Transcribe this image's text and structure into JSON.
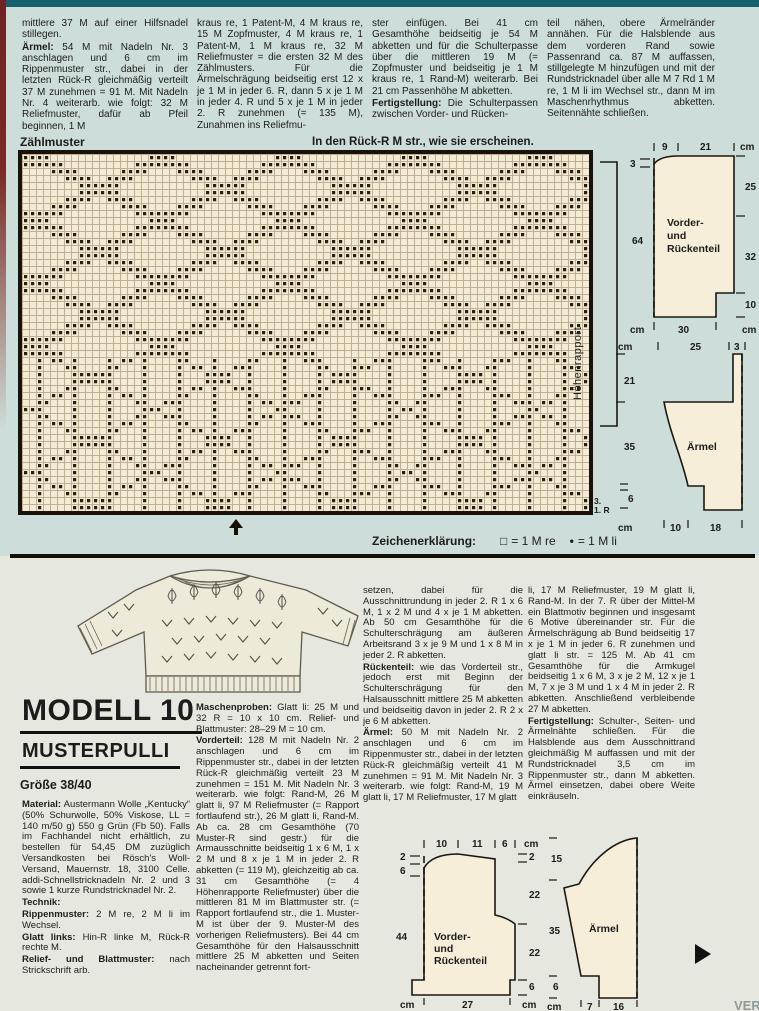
{
  "page": {
    "bg_top": "#cdddd9",
    "bg_bottom": "#e6e8e0",
    "teal_bar": "#155f6e",
    "spine": "#7b2a26",
    "divider": "#141008"
  },
  "top_article": {
    "col1": [
      [
        {
          "t": "mittlere 37 M auf einer Hilfsnadel stillegen."
        }
      ],
      [
        {
          "b": "Ärmel:"
        },
        {
          "t": " 54 M mit Nadeln Nr. 3 anschlagen und 6 cm im Rippenmuster str., dabei in der letzten Rück-R gleichmäßig verteilt 37 M zunehmen = 91 M. Mit Nadeln Nr. 4 weiterarb. wie folgt: 32 M Reliefmuster, dafür ab Pfeil beginnen, 1 M"
        }
      ]
    ],
    "col2": [
      [
        {
          "t": "kraus re, 1 Patent-M, 4 M kraus re, 15 M Zopfmuster, 4 M kraus re, 1 Patent-M, 1 M kraus re, 32 M Reliefmuster = die ersten 32 M des Zählmusters. Für die Ärmelschrägung beidseitig erst 12 x je 1 M in jeder 6. R, dann 5 x je 1 M in jeder 4. R und 5 x je 1 M in jeder 2. R zunehmen (= 135 M), Zunahmen ins Reliefmu-"
        }
      ]
    ],
    "col3": [
      [
        {
          "t": "ster einfügen. Bei 41 cm Gesamthöhe beidseitig je 54 M abketten und für die Schulterpasse über die mittleren 19 M (= Zopfmuster und beidseitig je 1 M kraus re, 1 Rand-M) weiterarb. Bei 21 cm Passenhöhe M abketten."
        }
      ],
      [
        {
          "b": "Fertigstellung:"
        },
        {
          "t": " Die Schulterpassen zwischen Vorder- und Rücken-"
        }
      ]
    ],
    "col4": [
      [
        {
          "t": "teil nähen, obere Ärmelränder annähen. Für die Halsblende aus dem vorderen Rand sowie Passenrand ca. 87 M auffassen, stillgelegte M hinzufügen und mit der Rundstricknadel über alle M 7 Rd 1 M re, 1 M li im Wechsel str., dann M im Maschenrhythmus abketten. Seitennähte schließen."
        }
      ]
    ]
  },
  "chart": {
    "title": "Zählmuster",
    "note": "In den Rück-R M str., wie sie erscheinen.",
    "side_label": "Höhenrapport",
    "mark_top": "3.",
    "mark_bottom": "1. R",
    "cols": 81,
    "rows": 51,
    "colors": {
      "bg": "#f3ebd6",
      "grid": "#bfb190",
      "dot": "#281e12"
    },
    "pattern": {
      "period": 18,
      "run": 4,
      "lower_start": 29,
      "stem_every": 5
    },
    "legend": {
      "title": "Zeichenerklärung:",
      "sq_symbol": "□",
      "sq_text": "= 1 M re",
      "dot_symbol": "•",
      "dot_text": "= 1 M li"
    }
  },
  "model": {
    "title": "MODELL 10",
    "subtitle": "MUSTERPULLI",
    "size": "Größe 38/40"
  },
  "bottom_article": {
    "col1": [
      [
        {
          "b": "Material:"
        },
        {
          "t": " Austermann Wolle „Kentucky“ (50% Schurwolle, 50% Viskose, LL = 140 m/50 g) 550 g Grün (Fb 50). Falls im Fachhandel nicht erhältlich, zu bestellen für 54,45 DM zuzüglich Versandkosten bei Rösch's Woll-Versand, Mauernstr. 18, 3100 Celle. addi-Schnellstricknadeln Nr. 2 und 3 sowie 1 kurze Rundstricknadel Nr. 2."
        }
      ],
      [
        {
          "b": "Technik:"
        }
      ],
      [
        {
          "b": "Rippenmuster:"
        },
        {
          "t": " 2 M re, 2 M li im Wechsel."
        }
      ],
      [
        {
          "b": "Glatt links:"
        },
        {
          "t": " Hin-R linke M, Rück-R rechte M."
        }
      ],
      [
        {
          "b": "Relief- und Blattmuster:"
        },
        {
          "t": " nach Strickschrift arb."
        }
      ]
    ],
    "col2": [
      [
        {
          "b": "Maschenproben:"
        },
        {
          "t": " Glatt li: 25 M und 32 R = 10 x 10 cm. Relief- und Blattmuster: 28–29 M = 10 cm."
        }
      ],
      [
        {
          "b": "Vorderteil:"
        },
        {
          "t": " 128 M mit Nadeln Nr. 2 anschlagen und 6 cm im Rippenmuster str., dabei in der letzten Rück-R gleichmäßig verteilt 23 M zunehmen = 151 M. Mit Nadeln Nr. 3 weiterarb. wie folgt: Rand-M, 26 M glatt li, 97 M Reliefmuster (= Rapport fortlaufend str.), 26 M glatt li, Rand-M. Ab ca. 28 cm Gesamthöhe (70 Muster-R sind gestr.) für die Armausschnitte beidseitig 1 x 6 M, 1 x 2 M und 8 x je 1 M in jeder 2. R abketten (= 119 M), gleichzeitig ab ca. 31 cm Gesamthöhe (= 4 Höhenrapporte Reliefmuster) über die mittleren 81 M im Blattmuster str. (= Rapport fortlaufend str., die 1. Muster-M ist über der 9. Muster-M des vorherigen Reliefmusters). Bei 44 cm Gesamthöhe für den Halsausschnitt mittlere 25 M abketten und Seiten nacheinander getrennt fort-"
        }
      ]
    ],
    "col3": [
      [
        {
          "t": "setzen, dabei für die Ausschnittrundung in jeder 2. R 1 x 6 M, 1 x 2 M und 4 x je 1 M abketten. Ab 50 cm Gesamthöhe für die Schulterschrägung am äußeren Arbeitsrand 3 x je 9 M und 1 x 8 M in jeder 2. R abketten."
        }
      ],
      [
        {
          "b": "Rückenteil:"
        },
        {
          "t": " wie das Vorderteil str., jedoch erst mit Beginn der Schulterschrägung für den Halsausschnitt mittlere 25 M abketten und beidseitig davon in jeder 2. R 2 x je 6 M abketten."
        }
      ],
      [
        {
          "b": "Ärmel:"
        },
        {
          "t": " 50 M mit Nadeln Nr. 2 anschlagen und 6 cm im Rippenmuster str., dabei in der letzten Rück-R gleichmäßig verteilt 41 M zunehmen = 91 M. Mit Nadeln Nr. 3 weiterarb. wie folgt: Rand-M, 19 M glatt li, 17 M Reliefmuster, 17 M glatt"
        }
      ]
    ],
    "col4": [
      [
        {
          "t": "li, 17 M Reliefmuster, 19 M glatt li, Rand-M. In der 7. R über der Mittel-M ein Blattmotiv beginnen und insgesamt 6 Motive übereinander str. Für die Ärmelschrägung ab Bund beidseitig 17 x je 1 M in jeder 6. R zunehmen und glatt li str. = 125 M. Ab 41 cm Gesamthöhe für die Armkugel beidseitig 1 x 6 M, 3 x je 2 M, 12 x je 1 M, 7 x je 3 M und 1 x 4 M in jeder 2. R abketten. Anschließend verbleibende 27 M abketten."
        }
      ],
      [
        {
          "b": "Fertigstellung:"
        },
        {
          "t": " Schulter-, Seiten- und Ärmelnähte schließen. Für die Halsblende aus dem Ausschnittrand gleichmäßig M auffassen und mit der Rundstricknadel 3,5 cm im Rippenmuster str., dann M abketten. Ärmel einsetzen, dabei obere Weite einkräuseln."
        }
      ]
    ]
  },
  "sch_a": {
    "t9": "9",
    "t21": "21",
    "cm_top": "cm",
    "l3": "3",
    "l64": "64",
    "r25": "25",
    "r32": "32",
    "r10": "10",
    "b30": "30",
    "cm_bl": "cm",
    "cm_br": "cm",
    "label1": "Vorder-",
    "label2": "und",
    "label3": "Rückenteil"
  },
  "sch_b": {
    "cm_top": "cm",
    "t25": "25",
    "t3": "3",
    "l21": "21",
    "l35": "35",
    "l6": "6",
    "cm_bot": "cm",
    "b10": "10",
    "b18": "18",
    "label": "Ärmel"
  },
  "sch_c": {
    "t10": "10",
    "t11": "11",
    "t6": "6",
    "cm_top": "cm",
    "l2": "2",
    "l6": "6",
    "l44": "44",
    "r2": "2",
    "r22a": "22",
    "r22b": "22",
    "r6": "6",
    "b27": "27",
    "cm_bl": "cm",
    "cm_br": "cm",
    "label1": "Vorder-",
    "label2": "und",
    "label3": "Rückenteil"
  },
  "sch_d": {
    "l15": "15",
    "l35": "35",
    "l6": "6",
    "cm_bot": "cm",
    "b7": "7",
    "b16": "16",
    "label": "Ärmel"
  },
  "footer": {
    "magazine": "VERE"
  }
}
